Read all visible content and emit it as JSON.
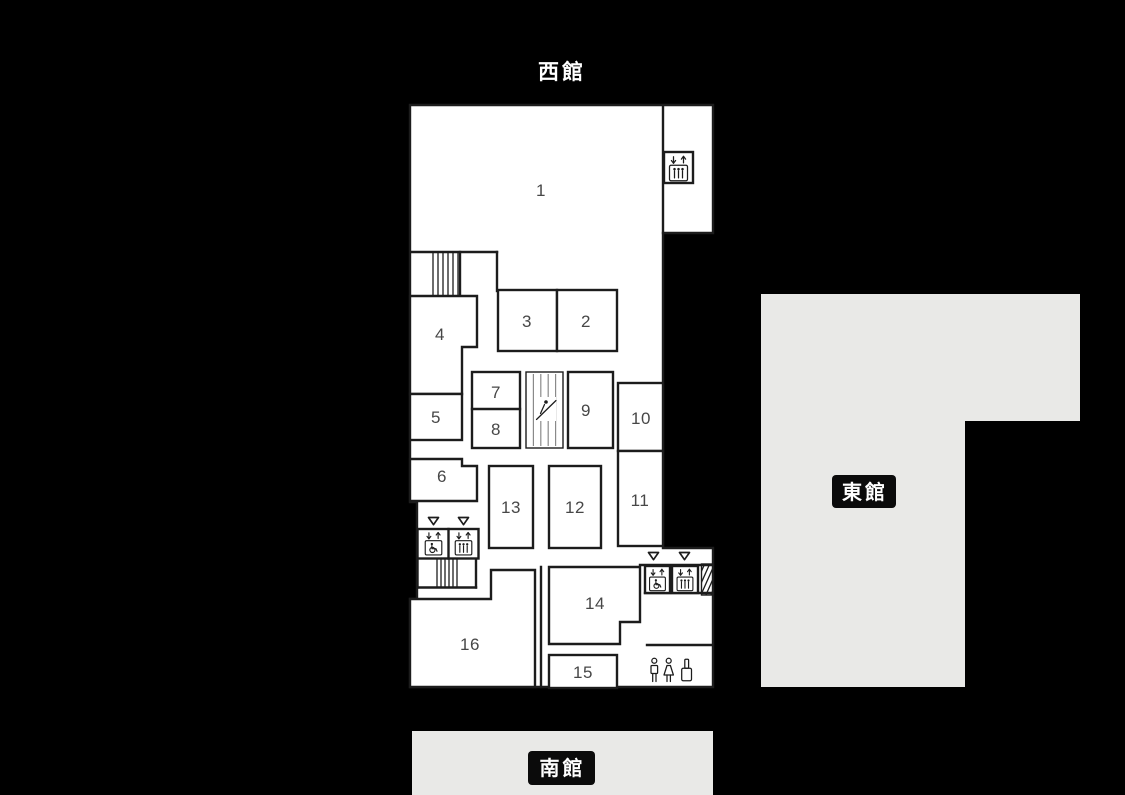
{
  "page": {
    "background": "#000000"
  },
  "buildings": {
    "west": {
      "label": "西館"
    },
    "east": {
      "label": "東館"
    },
    "south": {
      "label": "南館"
    }
  },
  "rooms": {
    "r1": "1",
    "r2": "2",
    "r3": "3",
    "r4": "4",
    "r5": "5",
    "r6": "6",
    "r7": "7",
    "r8": "8",
    "r9": "9",
    "r10": "10",
    "r11": "11",
    "r12": "12",
    "r13": "13",
    "r14": "14",
    "r15": "15",
    "r16": "16"
  },
  "icons": {
    "elevator": "elevator-icon",
    "accessible_elevator": "accessible-elevator-icon",
    "escalator": "escalator-icon",
    "stairs": "stairs-icon",
    "hatched_stairs": "hatched-stairs-icon",
    "restroom": "restroom-icon",
    "bottle": "bottle-icon",
    "marker": "down-triangle-icon"
  },
  "colors": {
    "bg": "#000000",
    "plan": "#ffffff",
    "wall": "#1c1c1c",
    "num": "#474747",
    "building-fill": "#e9e9e7",
    "plate-bg": "#0b0b0b",
    "plate-text": "#ffffff"
  }
}
